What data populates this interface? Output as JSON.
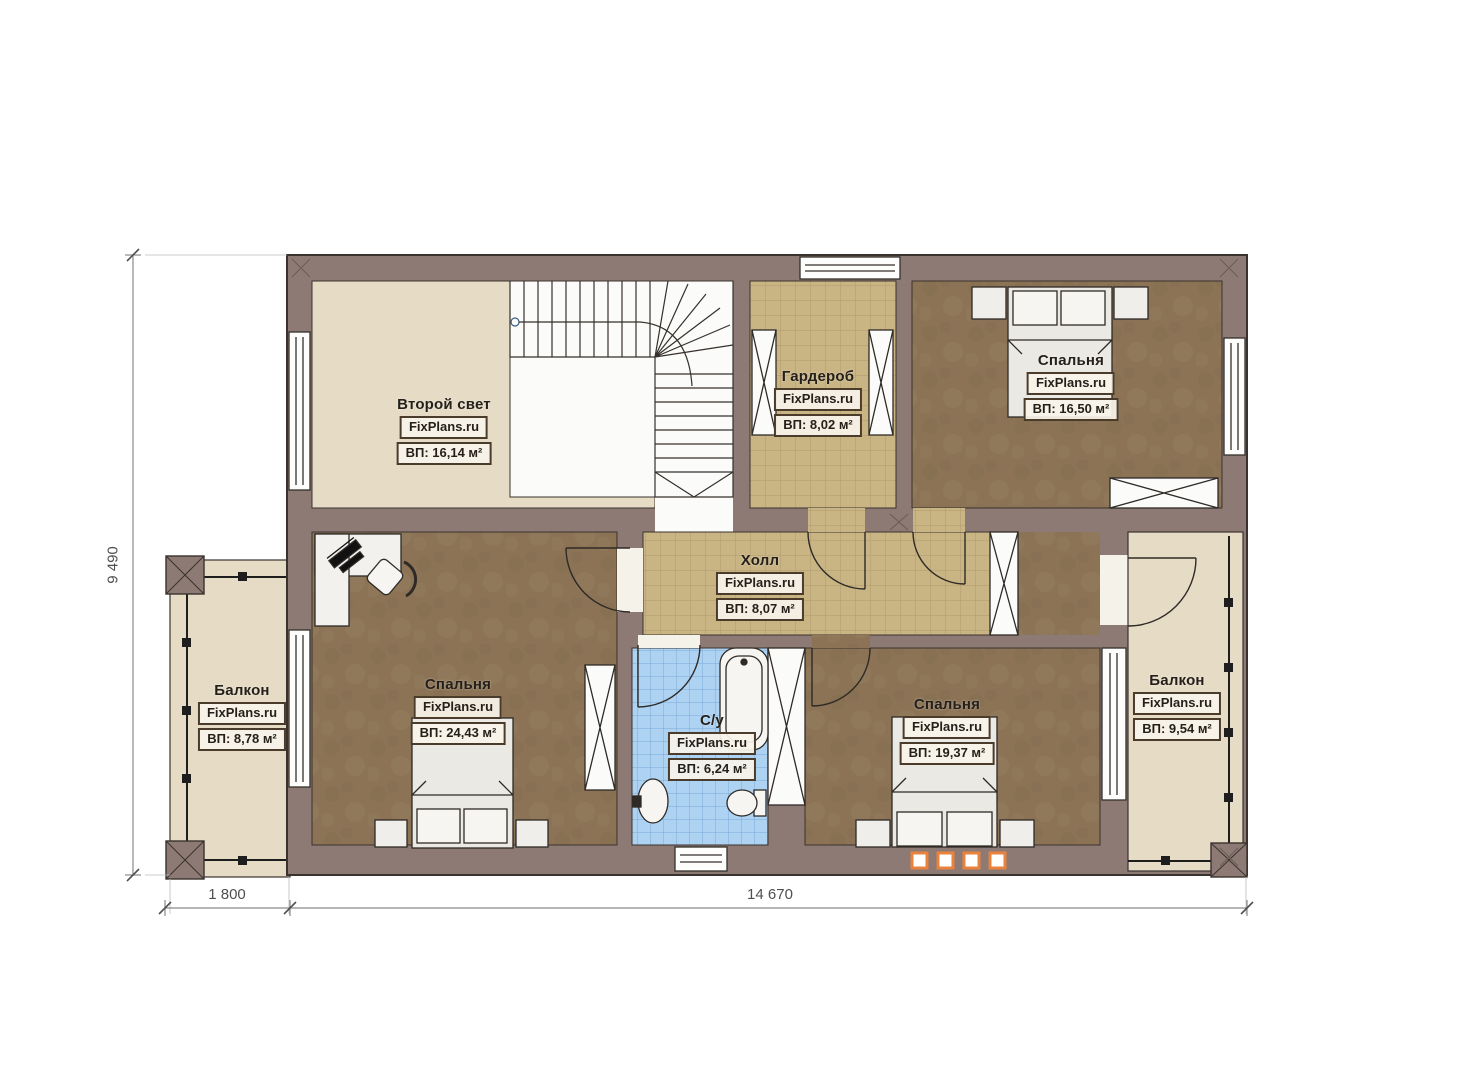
{
  "plan": {
    "brand": "FixPlans.ru",
    "rooms": [
      {
        "id": "second-light",
        "name": "Второй свет",
        "area": "ВП: 16,14 м²"
      },
      {
        "id": "wardrobe",
        "name": "Гардероб",
        "area": "ВП: 8,02 м²"
      },
      {
        "id": "bedroom-top-right",
        "name": "Спальня",
        "area": "ВП: 16,50 м²"
      },
      {
        "id": "hall",
        "name": "Холл",
        "area": "ВП: 8,07 м²"
      },
      {
        "id": "balcony-left",
        "name": "Балкон",
        "area": "ВП: 8,78 м²"
      },
      {
        "id": "bedroom-bottom-left",
        "name": "Спальня",
        "area": "ВП: 24,43 м²"
      },
      {
        "id": "bathroom",
        "name": "С/у",
        "area": "ВП: 6,24 м²"
      },
      {
        "id": "bedroom-bottom-right",
        "name": "Спальня",
        "area": "ВП: 19,37 м²"
      },
      {
        "id": "balcony-right",
        "name": "Балкон",
        "area": "ВП: 9,54 м²"
      }
    ],
    "dimensions": {
      "height": "9 490",
      "balcony_width": "1 800",
      "house_width": "14 670"
    },
    "colors": {
      "wall": "#8d7a74",
      "floor_light": "#e6dcc6",
      "floor_wood": "#8c7356",
      "tile_tan": "#c9b484",
      "tile_blue": "#aed2f2",
      "radiator_accent": "#e8823c"
    }
  }
}
